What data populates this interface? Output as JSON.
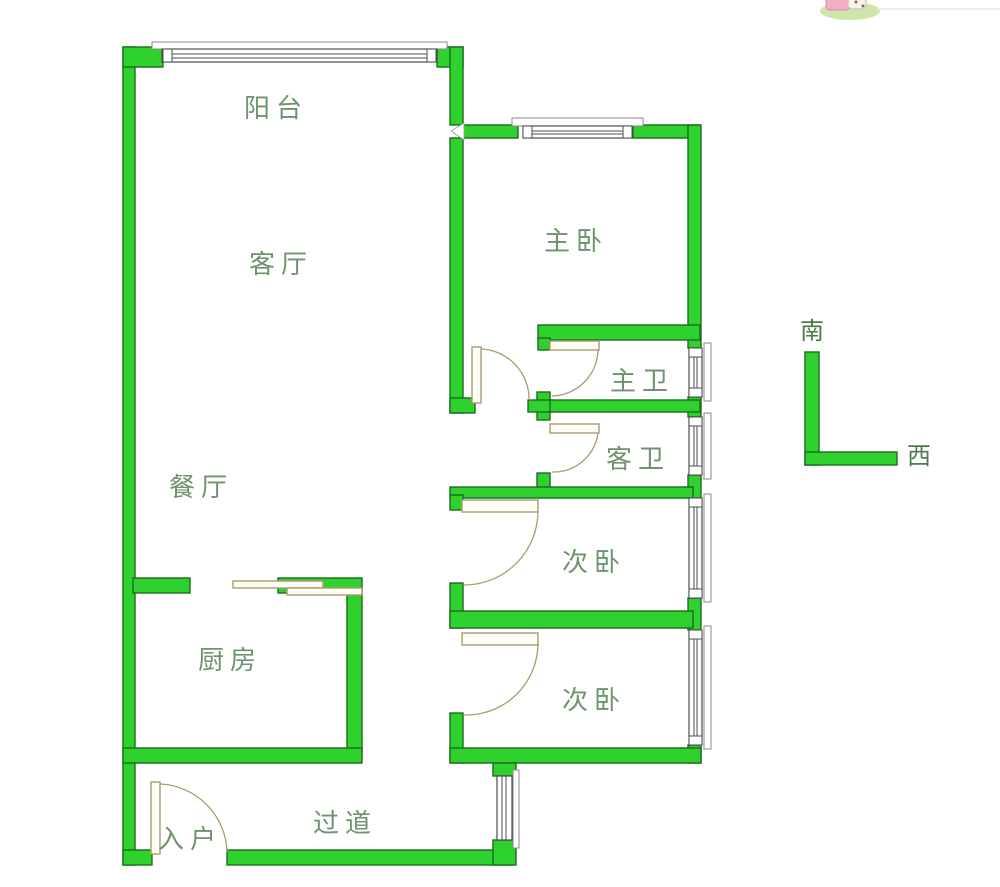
{
  "rooms": {
    "balcony": {
      "label": "阳台"
    },
    "living": {
      "label": "客厅"
    },
    "master_bedroom": {
      "label": "主卧"
    },
    "master_bath": {
      "label": "主卫"
    },
    "guest_bath": {
      "label": "客卫"
    },
    "second_bedroom_1": {
      "label": "次卧"
    },
    "second_bedroom_2": {
      "label": "次卧"
    },
    "dining": {
      "label": "餐厅"
    },
    "kitchen": {
      "label": "厨房"
    },
    "hallway": {
      "label": "过道"
    },
    "entrance": {
      "label": "入户"
    }
  },
  "compass": {
    "south_label": "南",
    "west_label": "西"
  },
  "colors": {
    "wall_green": "#2ed12e",
    "wall_border": "#1e6b1e",
    "room_label_green": "#6f936f",
    "compass_text_green": "#4c7a4c",
    "door_tan": "#ab9c6d",
    "window_stroke": "#4d4d4d",
    "background": "#ffffff"
  }
}
